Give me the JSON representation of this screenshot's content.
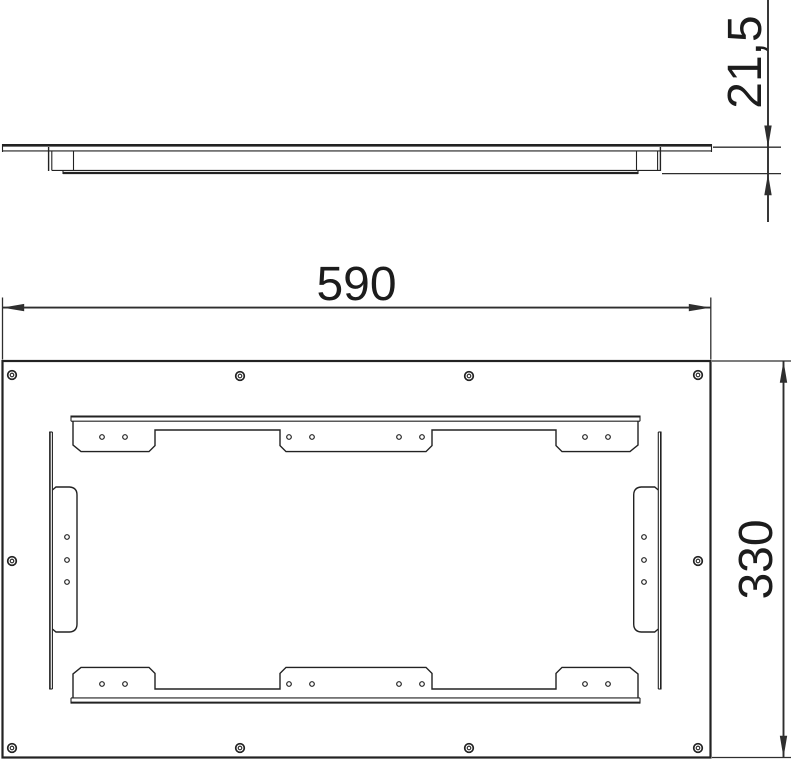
{
  "drawing": {
    "type": "technical-drawing",
    "background_color": "#ffffff",
    "line_color": "#222222",
    "dimension_color": "#2e2e2e",
    "views": {
      "side_view": {
        "name": "side profile view"
      },
      "front_view": {
        "name": "front view"
      }
    }
  },
  "dimensions": {
    "side_depth": {
      "label": "21,5",
      "orientation": "vertical-rotated"
    },
    "front_width": {
      "label": "590",
      "orientation": "horizontal"
    },
    "front_height": {
      "label": "330",
      "orientation": "vertical-rotated"
    }
  },
  "front_view": {
    "plate_hole_outer_radius": 4.3,
    "plate_hole_inner_radius": 1.8,
    "tab_hole_radius": 2.3,
    "plate_hole_centers": [
      [
        12,
        375
      ],
      [
        240,
        376
      ],
      [
        469,
        376
      ],
      [
        698,
        375
      ],
      [
        12,
        561
      ],
      [
        698,
        561
      ],
      [
        12,
        748
      ],
      [
        240,
        748
      ],
      [
        469,
        748
      ],
      [
        698,
        748
      ]
    ],
    "tab_hole_centers": [
      [
        102,
        437
      ],
      [
        125,
        437
      ],
      [
        289,
        437
      ],
      [
        312,
        437
      ],
      [
        399,
        437
      ],
      [
        422,
        437
      ],
      [
        585,
        437
      ],
      [
        608,
        437
      ],
      [
        102,
        684
      ],
      [
        125,
        684
      ],
      [
        289,
        684
      ],
      [
        312,
        684
      ],
      [
        399,
        684
      ],
      [
        422,
        684
      ],
      [
        585,
        684
      ],
      [
        608,
        684
      ],
      [
        67,
        537
      ],
      [
        67,
        560
      ],
      [
        67,
        582
      ],
      [
        644,
        537
      ],
      [
        644,
        560
      ],
      [
        644,
        582
      ]
    ]
  }
}
